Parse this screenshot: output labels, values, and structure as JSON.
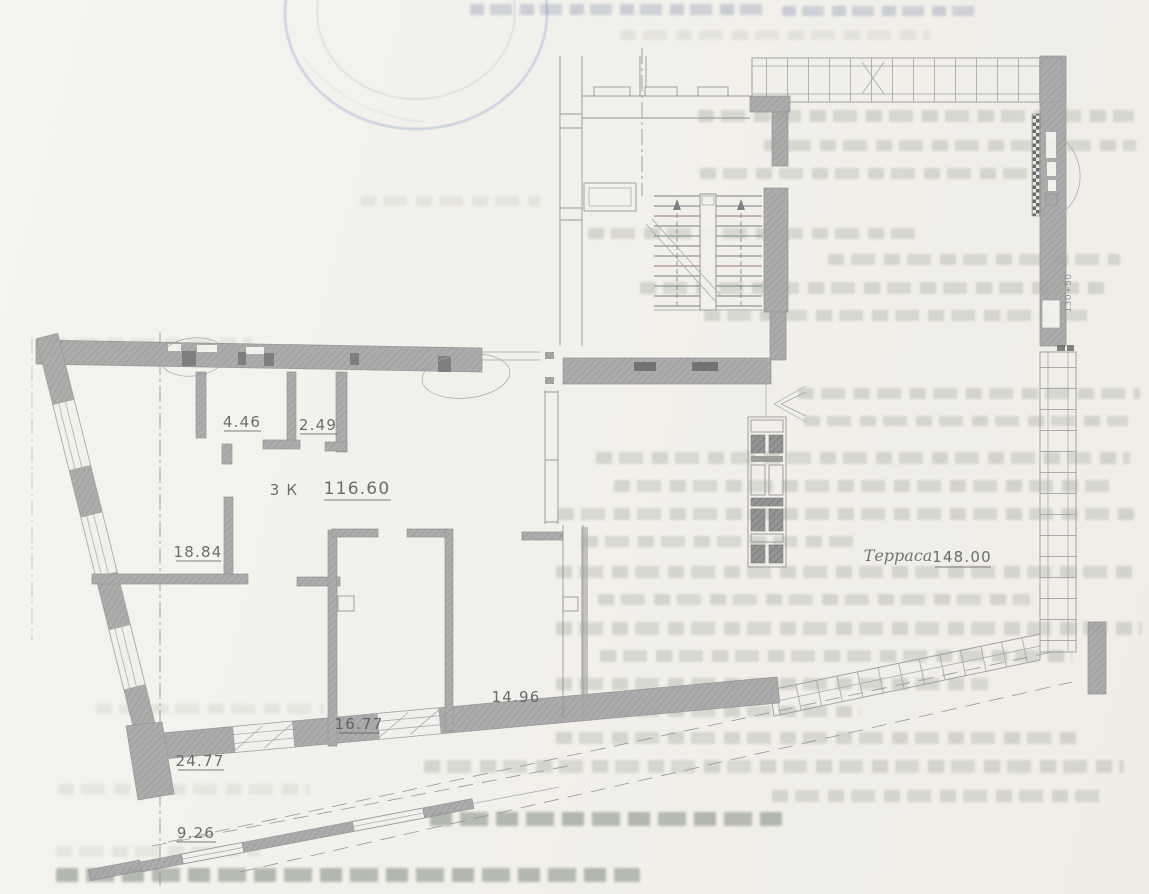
{
  "plan": {
    "unit_rooms_label": "3 К",
    "unit_total_area": "116.60",
    "areas": {
      "a446": "4.46",
      "a249": "2.49",
      "a1884": "18.84",
      "a2477": "24.77",
      "a1677": "16.77",
      "a1496": "14.96",
      "a926": "9.26"
    },
    "terrace_label": "Терраса",
    "terrace_area": "148.00",
    "dimension_note": "130+50"
  },
  "colors": {
    "paper": "#f1efe9",
    "wall_fill": "#a7a7a7",
    "ink": "#4e4e54",
    "stamp_blue": "#7d96cd",
    "bleed_text": "#7d8778"
  }
}
